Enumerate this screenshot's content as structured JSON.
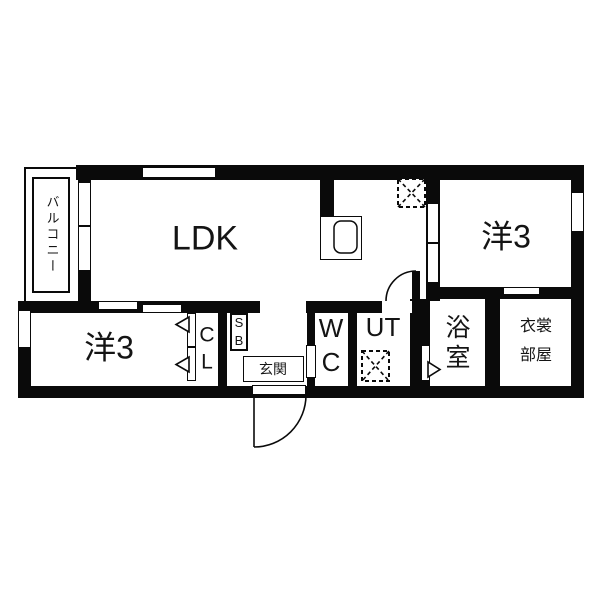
{
  "plan_title": "1LDK apartment floor plan",
  "colors": {
    "wall": "#0a0a0a",
    "background": "#ffffff",
    "text": "#141414"
  },
  "rooms": {
    "ldk": "LDK",
    "bedroom_top": "洋3",
    "bedroom_bottom": "洋3",
    "balcony": "バルコニー",
    "closet": "C\nL",
    "shoe_box": "S\nB",
    "entrance": "玄関",
    "toilet": "W\nC",
    "utility": "UT",
    "bathroom": "浴\n室",
    "dressing_room": "衣裳\n部屋"
  }
}
